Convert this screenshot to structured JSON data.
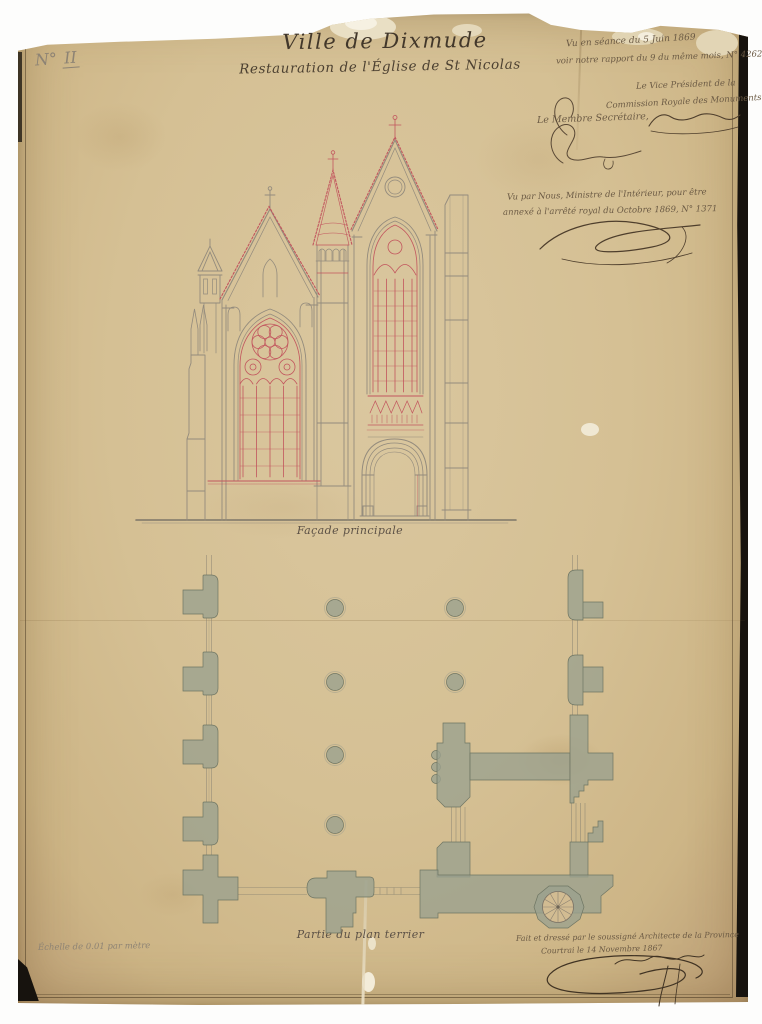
{
  "sheet": {
    "number_label": "N°",
    "number_value": "II",
    "title": "Ville de Dixmude",
    "subtitle": "Restauration de l'Église de St Nicolas"
  },
  "annotations": {
    "session_line1": "Vu en séance du 5 Juin 1869",
    "session_line2": "voir notre rapport du 9 du même mois, N° 4262",
    "vice_president_line1": "Le Vice Président de la",
    "vice_president_line2": "Commission Royale des Monuments",
    "secretary_label": "Le Membre Secrétaire,",
    "approval_line1": "Vu par Nous, Ministre de l'Intérieur, pour être",
    "approval_line2": "annexé à l'arrêté royal du  Octobre 1869, N° 1371",
    "architect_line1": "Fait et dressé par le soussigné Architecte de la Province",
    "architect_line2": "Courtrai le 14 Novembre 1867",
    "scale_note": "Échelle de 0.01 par mètre"
  },
  "captions": {
    "elevation": "Façade principale",
    "plan": "Partie du plan terrier"
  },
  "colors": {
    "paper": "#d5c094",
    "ink": "#4a3d2e",
    "pencil_gray": "#938b7d",
    "red_ink": "#c2565e",
    "plan_wash": "#9ba18f"
  }
}
